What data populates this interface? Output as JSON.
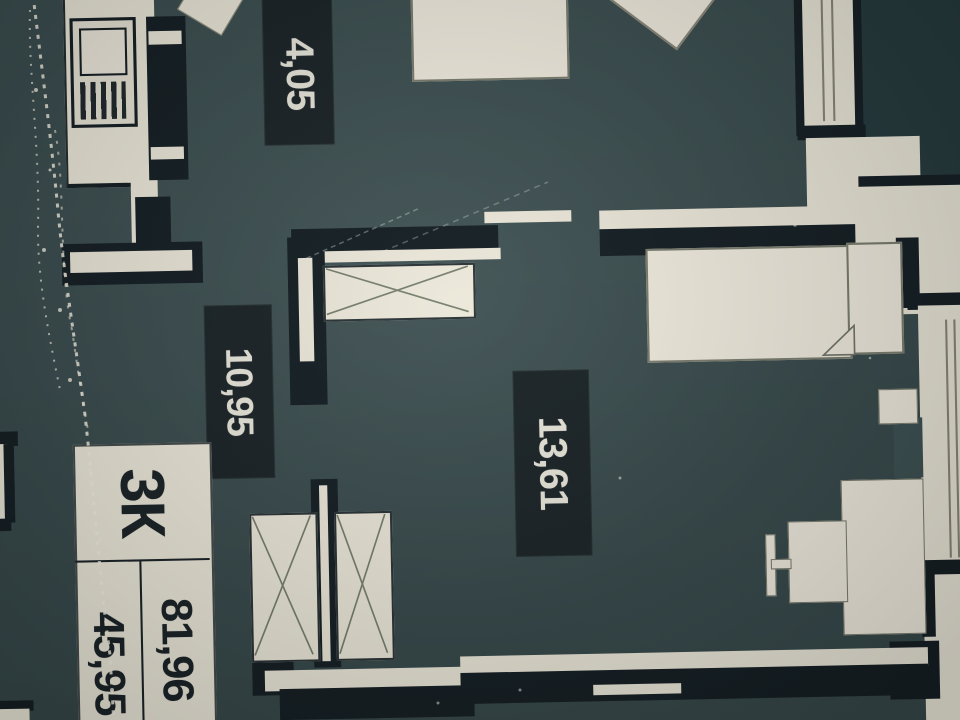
{
  "floorplan": {
    "unit_label": "3К",
    "area_total": "81,96",
    "area_living": "45,95",
    "room_areas": [
      {
        "name": "room-area-top",
        "value": "4,05"
      },
      {
        "name": "room-area-left",
        "value": "10,95"
      },
      {
        "name": "room-area-bottom-right",
        "value": "13,61"
      },
      {
        "name": "room-area-edge-partial",
        "value": "8,56"
      }
    ]
  },
  "colors": {
    "floor": "#3e5254",
    "floor_dark": "#263b3e",
    "wall_ink": "#151f24",
    "paper": "#ece8da",
    "paper_bright": "#f1ecdf",
    "label_bg": "#1b2428",
    "label_text": "#e9e7db"
  }
}
